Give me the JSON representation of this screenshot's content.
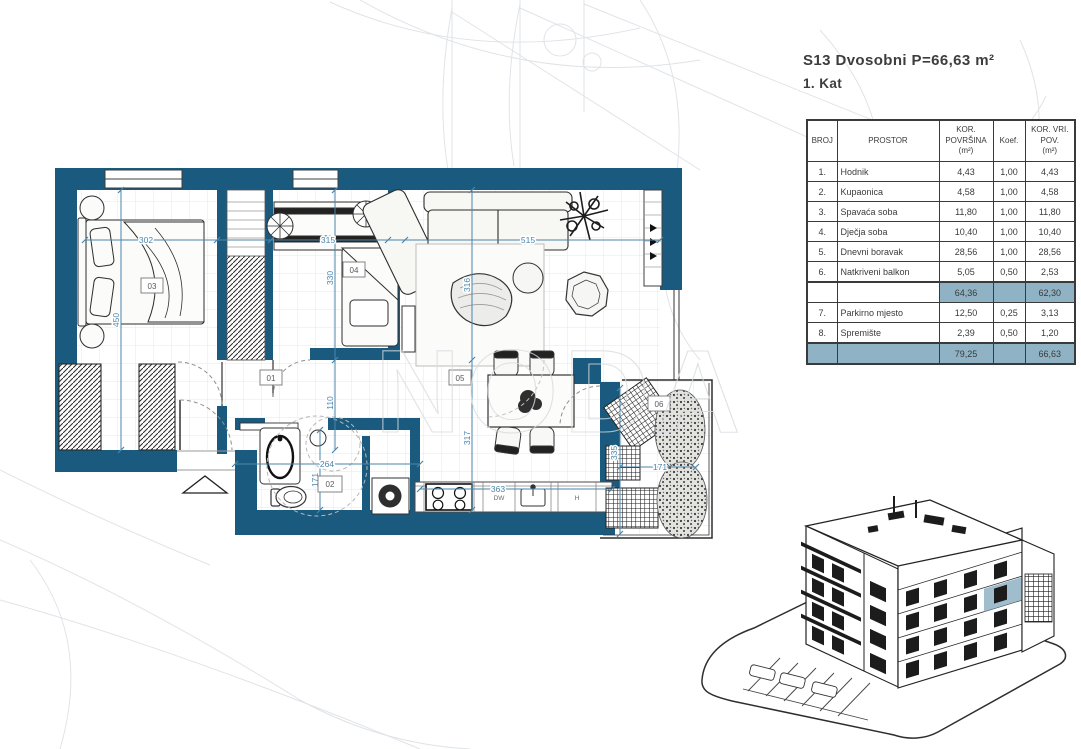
{
  "header": {
    "title": "S13 Dvosobni  P=66,63 m²",
    "subtitle": "1. Kat"
  },
  "table": {
    "columns": [
      "BROJ",
      "PROSTOR",
      "KOR.\nPOVRŠINA\n(m²)",
      "Koef.",
      "KOR. VRI.\nPOV.\n(m²)"
    ],
    "rows": [
      {
        "type": "data",
        "cells": [
          "1.",
          "Hodnik",
          "4,43",
          "1,00",
          "4,43"
        ]
      },
      {
        "type": "data",
        "cells": [
          "2.",
          "Kupaonica",
          "4,58",
          "1,00",
          "4,58"
        ]
      },
      {
        "type": "data",
        "cells": [
          "3.",
          "Spavaća soba",
          "11,80",
          "1,00",
          "11,80"
        ]
      },
      {
        "type": "data",
        "cells": [
          "4.",
          "Dječja soba",
          "10,40",
          "1,00",
          "10,40"
        ]
      },
      {
        "type": "data",
        "cells": [
          "5.",
          "Dnevni boravak",
          "28,56",
          "1,00",
          "28,56"
        ]
      },
      {
        "type": "data",
        "cells": [
          "6.",
          "Natkriveni balkon",
          "5,05",
          "0,50",
          "2,53"
        ]
      },
      {
        "type": "subtotal",
        "cells": [
          "",
          "",
          "64,36",
          "",
          "62,30"
        ]
      },
      {
        "type": "data",
        "cells": [
          "7.",
          "Parkirno mjesto",
          "12,50",
          "0,25",
          "3,13"
        ]
      },
      {
        "type": "data",
        "cells": [
          "8.",
          "Spremište",
          "2,39",
          "0,50",
          "1,20"
        ]
      },
      {
        "type": "total",
        "cells": [
          "",
          "",
          "79,25",
          "",
          "66,63"
        ]
      }
    ]
  },
  "plan": {
    "rooms": {
      "r1": "01",
      "r2": "02",
      "r3": "03",
      "r4": "04",
      "r5": "05",
      "r6": "06"
    },
    "dims": {
      "bedroom_w": "302",
      "bedroom_h": "450",
      "child_w": "315",
      "child_h": "330",
      "hall_h": "110",
      "living_w": "515",
      "living_h": "316",
      "dining_h": "317",
      "kitchen_w": "363",
      "bath_w": "264",
      "bath_h": "171",
      "balcony_w": "171",
      "balcony_h": "335"
    },
    "kitchen": {
      "dishwasher": "DW",
      "hood": "H"
    }
  },
  "watermark": "NODA",
  "colors": {
    "wall": "#1a5a7e",
    "dimension": "#4b86ab",
    "table_highlight": "#8fb2c4"
  }
}
